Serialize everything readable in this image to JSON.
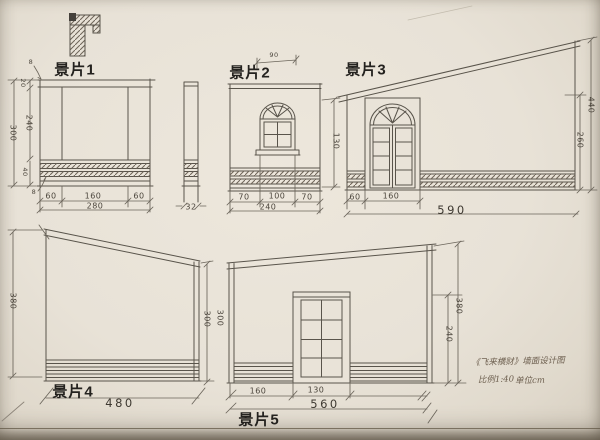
{
  "drawing": {
    "panels": {
      "p1": {
        "label": "景片1",
        "dims": {
          "height_total": "300",
          "height_mid": "240",
          "top_rail": "20",
          "thickness_top": "8",
          "skirting_height": "40",
          "thickness_skirting": "8",
          "bottom_left": "60",
          "bottom_mid": "160",
          "bottom_right": "60",
          "bottom_total": "280",
          "return_width": "32"
        }
      },
      "p2": {
        "label": "景片2",
        "dims": {
          "top_width": "90",
          "window_height": "130",
          "bottom_left": "70",
          "bottom_mid": "100",
          "bottom_right": "70",
          "bottom_total": "240"
        }
      },
      "p3": {
        "label": "景片3",
        "dims": {
          "bottom_left": "60",
          "bottom_door": "160",
          "bottom_total": "590",
          "height_right": "440",
          "height_left": "260"
        }
      },
      "p4": {
        "label": "景片4",
        "dims": {
          "height_left": "380",
          "height_right": "300",
          "bottom_total": "480"
        }
      },
      "p5": {
        "label": "景片5",
        "dims": {
          "height_left": "300",
          "bottom_left": "160",
          "bottom_door": "130",
          "bottom_total": "560",
          "height_right": "380",
          "height_inner": "240"
        }
      }
    },
    "title_block": {
      "title": "《飞来横财》墙面设计图",
      "scale": "比例1:40",
      "unit": "单位cm"
    }
  }
}
